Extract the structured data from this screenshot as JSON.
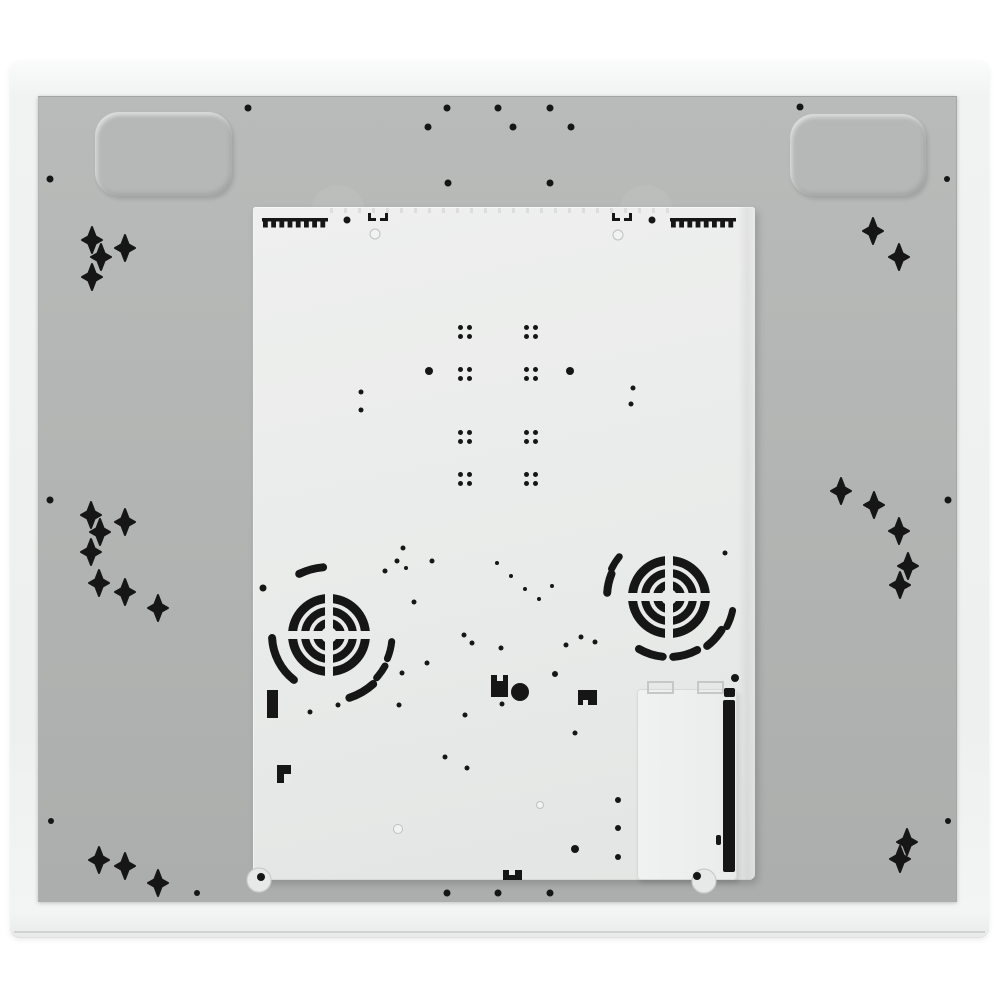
{
  "colors": {
    "page_bg": "#ffffff",
    "black": "#161616",
    "panel": "#e9ebea",
    "panel_foot": "#e7e9e8",
    "foot_ring": "#c9cbca",
    "light_hole_fill": "#f1f3f2",
    "light_hole_ring": "#bfc1c0",
    "tab_line": "#c6c8c7"
  },
  "layout": {
    "photo_frame": {
      "x": 10,
      "y": 61,
      "w": 979,
      "h": 877
    },
    "frame_bottom_line": {
      "x": 14,
      "y": 931,
      "w": 971,
      "h": 2
    },
    "baseplate": {
      "x": 38,
      "y": 96,
      "w": 919,
      "h": 806
    },
    "embossed_pads": [
      {
        "x": 95,
        "y": 112,
        "w": 137,
        "h": 84,
        "r": 24
      },
      {
        "x": 790,
        "y": 114,
        "w": 136,
        "h": 82,
        "r": 24
      }
    ],
    "fan_bosses": [
      {
        "cx": 338,
        "cy": 212,
        "r": 27
      },
      {
        "cx": 646,
        "cy": 212,
        "r": 27
      }
    ],
    "panel": {
      "x": 253,
      "y": 207,
      "w": 502,
      "h": 673
    },
    "panel_shade": {
      "x": 738,
      "y": 207,
      "w": 17,
      "h": 673
    },
    "serration": {
      "x": 330,
      "y": 208,
      "w": 345,
      "h": 5
    },
    "terminal_box": {
      "x": 637,
      "y": 689,
      "w": 100,
      "h": 191
    }
  },
  "features": {
    "cross_size": {
      "v": 13,
      "h": 10,
      "d": 3.6
    },
    "crosses": [
      [
        92,
        240
      ],
      [
        125,
        248
      ],
      [
        101,
        257
      ],
      [
        92,
        277
      ],
      [
        873,
        231
      ],
      [
        899,
        257
      ],
      [
        91,
        515
      ],
      [
        125,
        522
      ],
      [
        100,
        532
      ],
      [
        91,
        552
      ],
      [
        99,
        583
      ],
      [
        125,
        592
      ],
      [
        158,
        608
      ],
      [
        841,
        491
      ],
      [
        874,
        505
      ],
      [
        899,
        531
      ],
      [
        908,
        566
      ],
      [
        900,
        585
      ],
      [
        99,
        860
      ],
      [
        125,
        866
      ],
      [
        158,
        883
      ],
      [
        907,
        842
      ],
      [
        900,
        859
      ]
    ],
    "gray_dots": [
      [
        248,
        108,
        7
      ],
      [
        447,
        108,
        7
      ],
      [
        498,
        108,
        7
      ],
      [
        550,
        108,
        7
      ],
      [
        428,
        127,
        7
      ],
      [
        513,
        127,
        7
      ],
      [
        571,
        127,
        7
      ],
      [
        448,
        183,
        7
      ],
      [
        550,
        183,
        7
      ],
      [
        800,
        107,
        7
      ],
      [
        947,
        179,
        6
      ],
      [
        50,
        179,
        7
      ],
      [
        50,
        500,
        7
      ],
      [
        948,
        500,
        7
      ],
      [
        51,
        821,
        6
      ],
      [
        197,
        893,
        6
      ],
      [
        948,
        821,
        6
      ],
      [
        447,
        893,
        7
      ],
      [
        498,
        893,
        7
      ],
      [
        550,
        893,
        7
      ]
    ],
    "panel_dots": [
      [
        347,
        220,
        7
      ],
      [
        652,
        220,
        7
      ],
      [
        429,
        371,
        8
      ],
      [
        570,
        371,
        8
      ],
      [
        361,
        392,
        5
      ],
      [
        361,
        410,
        5
      ],
      [
        633,
        388,
        5
      ],
      [
        631,
        404,
        5
      ],
      [
        403,
        548,
        5
      ],
      [
        397,
        561,
        5
      ],
      [
        432,
        561,
        5
      ],
      [
        385,
        571,
        5
      ],
      [
        406,
        568,
        4
      ],
      [
        414,
        602,
        5
      ],
      [
        263,
        588,
        7
      ],
      [
        725,
        553,
        5
      ],
      [
        497,
        563,
        4
      ],
      [
        511,
        576,
        4
      ],
      [
        525,
        589,
        4
      ],
      [
        539,
        599,
        4
      ],
      [
        552,
        586,
        4
      ],
      [
        427,
        663,
        5
      ],
      [
        402,
        673,
        5
      ],
      [
        399,
        705,
        5
      ],
      [
        338,
        705,
        5
      ],
      [
        310,
        712,
        5
      ],
      [
        464,
        635,
        5
      ],
      [
        472,
        643,
        5
      ],
      [
        501,
        648,
        5
      ],
      [
        566,
        645,
        5
      ],
      [
        581,
        637,
        5
      ],
      [
        595,
        642,
        5
      ],
      [
        555,
        674,
        6
      ],
      [
        465,
        715,
        5
      ],
      [
        502,
        704,
        5
      ],
      [
        575,
        733,
        5
      ],
      [
        445,
        757,
        5
      ],
      [
        467,
        768,
        5
      ],
      [
        618,
        800,
        6
      ],
      [
        618,
        828,
        6
      ],
      [
        618,
        857,
        6
      ],
      [
        575,
        849,
        8
      ],
      [
        520,
        692,
        18
      ]
    ],
    "dot_clusters": {
      "pitch": 9,
      "dot_d": 5,
      "centers": [
        [
          465,
          332
        ],
        [
          531,
          332
        ],
        [
          465,
          374
        ],
        [
          531,
          374
        ],
        [
          465,
          437
        ],
        [
          531,
          437
        ],
        [
          465,
          479
        ],
        [
          531,
          479
        ]
      ]
    },
    "light_holes": [
      [
        375,
        234,
        10
      ],
      [
        618,
        235,
        10
      ],
      [
        398,
        829,
        9
      ],
      [
        540,
        805,
        7
      ]
    ],
    "feet": [
      [
        259,
        880,
        12
      ],
      [
        704,
        881,
        12
      ]
    ],
    "screws": [
      [
        261,
        877,
        8
      ],
      [
        697,
        876,
        8
      ],
      [
        735,
        678,
        8
      ]
    ],
    "fans": {
      "centers": [
        [
          329,
          635
        ],
        [
          669,
          597
        ]
      ],
      "rings": [
        [
          12,
          8
        ],
        [
          24,
          8
        ],
        [
          36.5,
          9
        ]
      ],
      "spoke_w": 8,
      "spoke_len": 84
    },
    "arcs": [
      [
        329,
        635,
        68,
        95,
        116,
        8
      ],
      [
        329,
        635,
        57,
        183,
        232,
        8
      ],
      [
        329,
        635,
        66,
        288,
        312,
        8
      ],
      [
        329,
        635,
        63,
        338,
        354,
        7
      ],
      [
        329,
        635,
        64,
        318,
        331,
        7
      ],
      [
        669,
        597,
        62,
        158,
        176,
        8
      ],
      [
        669,
        597,
        64,
        141,
        154,
        7
      ],
      [
        669,
        597,
        60,
        240,
        264,
        8
      ],
      [
        669,
        597,
        60,
        274,
        298,
        8
      ],
      [
        669,
        597,
        62,
        308,
        328,
        8
      ],
      [
        669,
        597,
        65,
        333,
        348,
        7
      ]
    ],
    "combs": {
      "positions": [
        [
          262,
          218
        ],
        [
          670,
          218
        ]
      ],
      "width": 66,
      "bar_h": 3.5,
      "teeth": 8,
      "tooth_w": 4.8,
      "tooth_h": 6.5,
      "tooth_pitch": 8.2
    },
    "brackets": [
      [
        368,
        213
      ],
      [
        612,
        213
      ]
    ],
    "marks": [
      {
        "rect": [
          267,
          690,
          11,
          28
        ],
        "notch": null
      },
      {
        "rect": [
          277,
          765,
          14,
          18
        ],
        "notch": [
          284,
          774,
          7,
          9
        ]
      },
      {
        "rect": [
          491,
          675,
          17,
          22
        ],
        "notch": [
          497,
          675,
          6,
          6
        ]
      },
      {
        "rect": [
          578,
          690,
          19,
          15
        ],
        "notch": [
          583,
          700,
          5,
          5
        ]
      },
      {
        "rect": [
          503,
          870,
          19,
          10
        ],
        "notch": [
          509,
          870,
          6,
          5
        ]
      }
    ],
    "box_tabs": [
      [
        648,
        682,
        25,
        11
      ],
      [
        698,
        682,
        25,
        11
      ]
    ],
    "box_slots": [
      [
        724,
        688,
        11,
        9
      ],
      [
        723,
        700,
        12,
        172
      ],
      [
        716,
        835,
        5,
        10
      ]
    ]
  }
}
